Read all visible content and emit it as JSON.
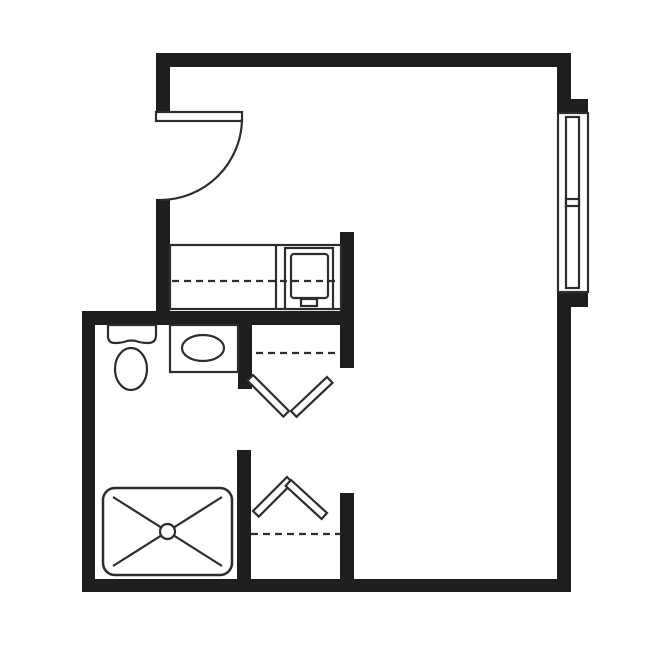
{
  "meta": {
    "drawing_kind": "architectural floor plan",
    "unit_type": "studio room",
    "visible_text": "none"
  },
  "colors": {
    "background": "#ffffff",
    "wall": "#1d1e20",
    "line": "#2b2d30"
  },
  "fixtures": [
    {
      "name": "entry-door",
      "kind": "swing-door-90deg"
    },
    {
      "name": "window",
      "kind": "double-hung-window"
    },
    {
      "name": "kitchenette-counter",
      "kind": "counter-with-dashed-overhead-line"
    },
    {
      "name": "refrigerator",
      "kind": "appliance-symbol"
    },
    {
      "name": "toilet",
      "kind": "toilet-tank-and-bowl"
    },
    {
      "name": "vanity-sink",
      "kind": "counter-with-oval-basin"
    },
    {
      "name": "upper-closet-door",
      "kind": "bifold-chevron-down"
    },
    {
      "name": "upper-closet-shelf",
      "kind": "dashed-line"
    },
    {
      "name": "lower-closet-door",
      "kind": "bifold-chevron-up"
    },
    {
      "name": "lower-closet-shelf",
      "kind": "dashed-line"
    },
    {
      "name": "shower",
      "kind": "shower-pan-x-drain"
    }
  ]
}
